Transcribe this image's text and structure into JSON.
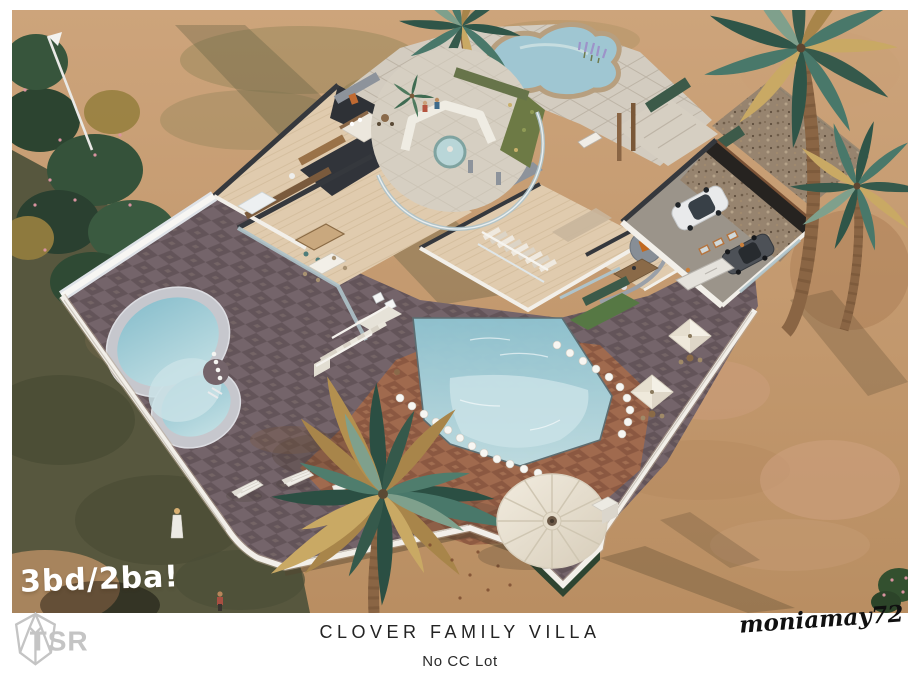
{
  "poster": {
    "badge": "3bd/2ba!",
    "title": "CLOVER FAMILY VILLA",
    "subtitle": "No CC Lot",
    "creator": "moniamay72",
    "logo": "TSR"
  },
  "palette": {
    "badge_white": "#ffffff",
    "text_dark": "#232323",
    "logo_gray": "#c4c4c4",
    "sand": "#c49a6f",
    "sand_shadow": "#57573e",
    "tile_dark": "#74646a",
    "tile_dark_alt": "#635459",
    "terracotta": "#a26a4c",
    "terracotta_alt": "#8d5840",
    "pool_water": "#9fc6d2",
    "pool_water_light": "#c9e2e6",
    "pool_rim": "#c6c7cd",
    "wood_floor": "#e0cbae",
    "wall_white": "#f2efe9",
    "wall_dark": "#35383d",
    "stone_gray": "#8d939b",
    "glass_blue": "#aec3ca",
    "hedge_green": "#3c5a49",
    "palm_green": "#49786a",
    "palm_gold": "#c9a964",
    "palm_trunk": "#8a6544",
    "paver_stone": "#d3ccc0",
    "umbrella_cream": "#ece5d6",
    "fence_white": "#f2efe9"
  }
}
